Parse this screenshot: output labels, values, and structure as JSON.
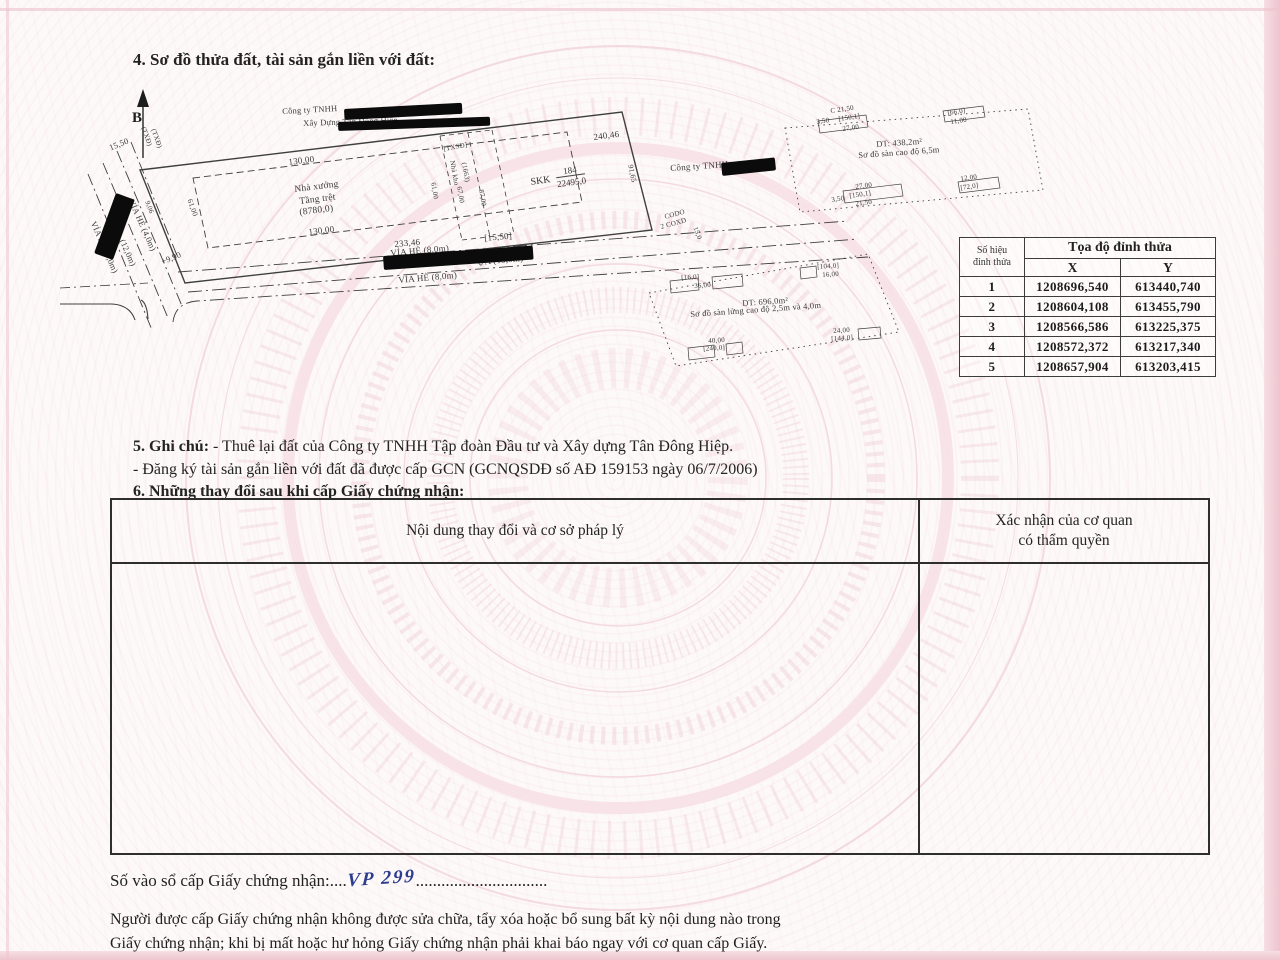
{
  "document": {
    "section4_title": "4. Sơ đồ thửa đất, tài sản gắn liền với đất:",
    "section5_label": "5. Ghi chú:",
    "section5_line1": "- Thuê lại đất của Công ty TNHH Tập đoàn Đầu tư và Xây dựng Tân Đông Hiệp.",
    "section5_line2": "- Đăng ký tài sản gắn liền với đất đã được cấp GCN (GCNQSDĐ số AĐ 159153 ngày 06/7/2006)",
    "section6_title": "6. Những thay đổi sau khi cấp Giấy chứng nhận:",
    "registry_label": "Số vào sổ cấp Giấy chứng nhận:",
    "registry_dots_before": "....",
    "registry_value": "VP 299",
    "registry_dots_after": "...............................",
    "footer_line1": "Người được cấp Giấy chứng nhận không được sửa chữa, tẩy xóa hoặc bổ sung bất kỳ nội dung nào trong",
    "footer_line2": "Giấy chứng nhận; khi bị mất hoặc hư hỏng Giấy chứng nhận phải khai báo ngay với cơ quan cấp Giấy."
  },
  "changes_table": {
    "col1": "Nội dung thay đổi và cơ sở pháp lý",
    "col2_line1": "Xác nhận của cơ quan",
    "col2_line2": "có thẩm quyền"
  },
  "coord_table": {
    "corner_line1": "Số hiệu",
    "corner_line2": "đỉnh thửa",
    "header": "Tọa độ đỉnh thửa",
    "x_label": "X",
    "y_label": "Y",
    "rows": [
      {
        "n": "1",
        "x": "1208696,540",
        "y": "613440,740"
      },
      {
        "n": "2",
        "x": "1208604,108",
        "y": "613455,790"
      },
      {
        "n": "3",
        "x": "1208566,586",
        "y": "613225,375"
      },
      {
        "n": "4",
        "x": "1208572,372",
        "y": "613217,340"
      },
      {
        "n": "5",
        "x": "1208657,904",
        "y": "613203,415"
      }
    ]
  },
  "map": {
    "north_label": "B",
    "skk_label": "SKK",
    "skk_numerator": "184",
    "skk_denominator": "22495,0",
    "labels": [
      {
        "t": "Công ty TNHH",
        "x": 282,
        "y": 107,
        "r": -3,
        "s": 8.5
      },
      {
        "t": "Xây Dựng Tân Đông Hiệp",
        "x": 303,
        "y": 119,
        "r": -2,
        "s": 8.5
      },
      {
        "t": "Công ty TNHH",
        "x": 670,
        "y": 164,
        "r": -4,
        "s": 9
      },
      {
        "t": "240,46",
        "x": 593,
        "y": 133,
        "r": -7,
        "s": 9
      },
      {
        "t": "130,00",
        "x": 288,
        "y": 158,
        "r": -7,
        "s": 9
      },
      {
        "t": "Nhà xưởng",
        "x": 294,
        "y": 186,
        "r": -7,
        "s": 9.5
      },
      {
        "t": "Tầng trệt",
        "x": 299,
        "y": 198,
        "r": -7,
        "s": 9.5
      },
      {
        "t": "(8780,0)",
        "x": 299,
        "y": 209,
        "r": -7,
        "s": 9.5
      },
      {
        "t": "130,00",
        "x": 308,
        "y": 228,
        "r": -7,
        "s": 9
      },
      {
        "t": "233,46",
        "x": 394,
        "y": 240,
        "r": -5,
        "s": 9
      },
      {
        "t": "[15,50]",
        "x": 484,
        "y": 234,
        "r": -5,
        "s": 9
      },
      {
        "t": "VỈA HÈ (8,0m)",
        "x": 390,
        "y": 249,
        "r": -5,
        "s": 9
      },
      {
        "t": "ỰA (15,0m)",
        "x": 477,
        "y": 258,
        "r": -5,
        "s": 9
      },
      {
        "t": "VỈA HÈ (8,0m)",
        "x": 398,
        "y": 276,
        "r": -5,
        "s": 9
      },
      {
        "t": "VỈA HÈ (4,0m)",
        "x": 97,
        "y": 220,
        "r": 66,
        "s": 8.5
      },
      {
        "t": "(12,0m)",
        "x": 126,
        "y": 238,
        "r": 66,
        "s": 8.5
      },
      {
        "t": "VỈA HÈ (4,0m)",
        "x": 135,
        "y": 198,
        "r": 66,
        "s": 8.5
      },
      {
        "t": "15,50",
        "x": 108,
        "y": 144,
        "r": -22,
        "s": 8.5
      },
      {
        "t": "(TXĐ)",
        "x": 146,
        "y": 126,
        "r": 70,
        "s": 7
      },
      {
        "t": "(TXĐ)",
        "x": 156,
        "y": 128,
        "r": 70,
        "s": 7
      },
      {
        "t": "9,06",
        "x": 150,
        "y": 200,
        "r": 70,
        "s": 7
      },
      {
        "t": "61,00",
        "x": 193,
        "y": 198,
        "r": 70,
        "s": 7.5
      },
      {
        "t": "+9,90",
        "x": 160,
        "y": 258,
        "r": -22,
        "s": 8.5
      },
      {
        "t": "[TXSĐ]",
        "x": 443,
        "y": 146,
        "r": -10,
        "s": 7
      },
      {
        "t": "Nhà kho",
        "x": 455,
        "y": 160,
        "r": 80,
        "s": 7
      },
      {
        "t": "(1663)",
        "x": 467,
        "y": 162,
        "r": 80,
        "s": 7
      },
      {
        "t": "61,00",
        "x": 436,
        "y": 182,
        "r": 80,
        "s": 7
      },
      {
        "t": "67,00",
        "x": 462,
        "y": 186,
        "r": 80,
        "s": 7
      },
      {
        "t": "87,00",
        "x": 484,
        "y": 189,
        "r": 80,
        "s": 7
      },
      {
        "t": "91,65",
        "x": 634,
        "y": 164,
        "r": 78,
        "s": 7.5
      },
      {
        "t": "CODO",
        "x": 664,
        "y": 214,
        "r": -15,
        "s": 7
      },
      {
        "t": "2 COXD",
        "x": 660,
        "y": 224,
        "r": -15,
        "s": 7
      },
      {
        "t": "15,0",
        "x": 698,
        "y": 226,
        "r": 70,
        "s": 7
      },
      {
        "t": "DT: 438,2m²",
        "x": 876,
        "y": 140,
        "r": -4,
        "s": 8.5
      },
      {
        "t": "Sơ đồ sàn cao độ 6,5m",
        "x": 858,
        "y": 151,
        "r": -4,
        "s": 8.5
      },
      {
        "t": "C 21,50",
        "x": 830,
        "y": 108,
        "r": -8,
        "s": 7
      },
      {
        "t": "3,50",
        "x": 816,
        "y": 119,
        "r": -8,
        "s": 7
      },
      {
        "t": "[150,1]",
        "x": 838,
        "y": 116,
        "r": -8,
        "s": 7
      },
      {
        "t": "27,00",
        "x": 842,
        "y": 126,
        "r": -8,
        "s": 7
      },
      {
        "t": "[66,0]",
        "x": 947,
        "y": 110,
        "r": -8,
        "s": 7
      },
      {
        "t": "11,00",
        "x": 950,
        "y": 119,
        "r": -8,
        "s": 7
      },
      {
        "t": "27,00",
        "x": 855,
        "y": 184,
        "r": -8,
        "s": 7
      },
      {
        "t": "[150,1]",
        "x": 849,
        "y": 193,
        "r": -8,
        "s": 7
      },
      {
        "t": "3,50",
        "x": 831,
        "y": 197,
        "r": -8,
        "s": 7
      },
      {
        "t": "21,50",
        "x": 855,
        "y": 201,
        "r": -8,
        "s": 7
      },
      {
        "t": "12,00",
        "x": 960,
        "y": 176,
        "r": -8,
        "s": 7
      },
      {
        "t": "[72,0]",
        "x": 960,
        "y": 185,
        "r": -8,
        "s": 7
      },
      {
        "t": "DT: 696,0m²",
        "x": 742,
        "y": 299,
        "r": -4,
        "s": 8.5
      },
      {
        "t": "Sơ đồ sàn lửng cao độ 2,5m và 4,0m",
        "x": 690,
        "y": 310,
        "r": -4,
        "s": 8.5
      },
      {
        "t": "[16,0]",
        "x": 681,
        "y": 275,
        "r": -4,
        "s": 7
      },
      {
        "t": "36,00",
        "x": 694,
        "y": 283,
        "r": -4,
        "s": 7
      },
      {
        "t": "[104,0]",
        "x": 817,
        "y": 264,
        "r": -4,
        "s": 7
      },
      {
        "t": "16,00",
        "x": 822,
        "y": 272,
        "r": -4,
        "s": 7
      },
      {
        "t": "40,00",
        "x": 708,
        "y": 338,
        "r": -4,
        "s": 7
      },
      {
        "t": "[240,0]",
        "x": 703,
        "y": 346,
        "r": -4,
        "s": 7
      },
      {
        "t": "24,00",
        "x": 833,
        "y": 328,
        "r": -4,
        "s": 7
      },
      {
        "t": "[144,0]",
        "x": 831,
        "y": 336,
        "r": -4,
        "s": 7
      }
    ],
    "redactions": [
      {
        "x": 344,
        "y": 109,
        "w": 118,
        "h": 11,
        "r": -3
      },
      {
        "x": 338,
        "y": 122,
        "w": 152,
        "h": 9,
        "r": -2
      },
      {
        "x": 721,
        "y": 163,
        "w": 54,
        "h": 13,
        "r": -6
      },
      {
        "x": 116,
        "y": 193,
        "w": 20,
        "h": 64,
        "r": 20
      },
      {
        "x": 383,
        "y": 256,
        "w": 150,
        "h": 14,
        "r": -4
      }
    ]
  }
}
